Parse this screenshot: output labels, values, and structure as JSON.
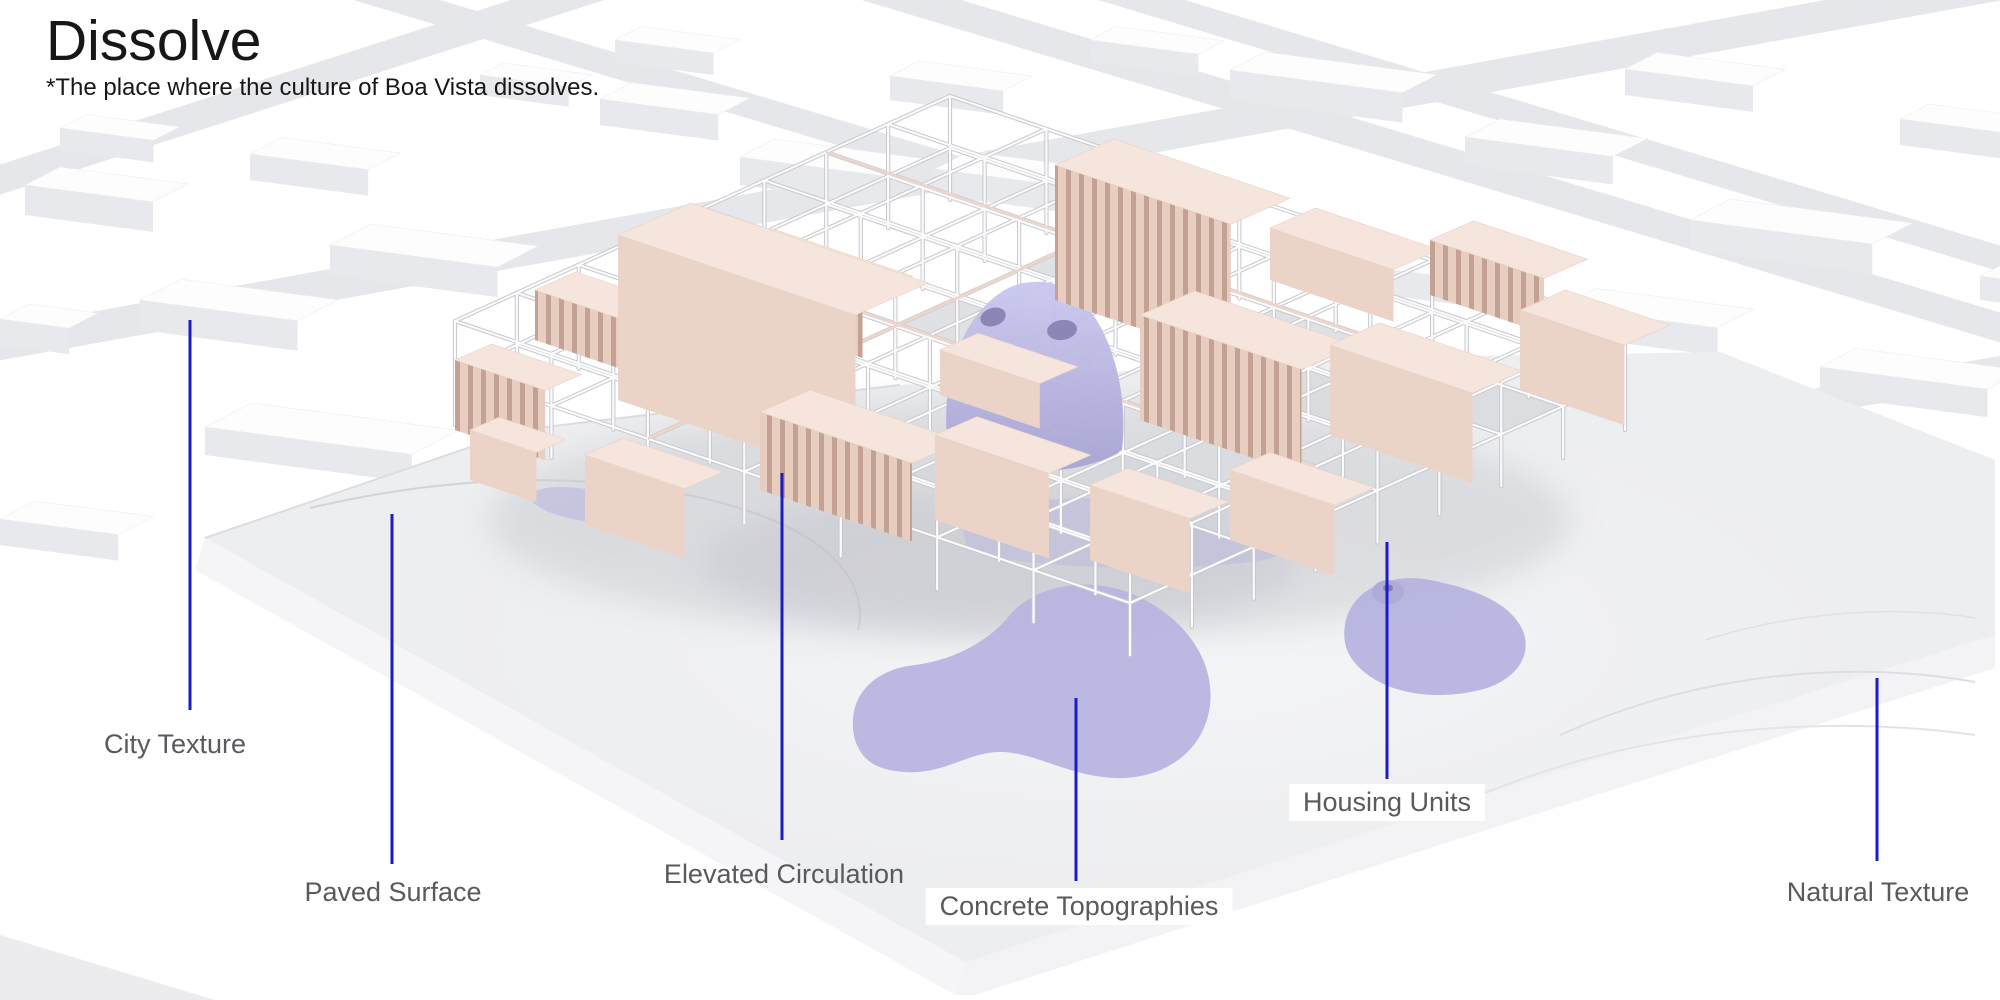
{
  "header": {
    "title": "Dissolve",
    "subtitle": "*The place where the culture of Boa Vista dissolves."
  },
  "legend": {
    "labels": [
      {
        "id": "city-texture",
        "text": "City Texture"
      },
      {
        "id": "paved-surface",
        "text": "Paved Surface"
      },
      {
        "id": "elevated-circulation",
        "text": "Elevated Circulation"
      },
      {
        "id": "concrete-topographies",
        "text": "Concrete Topographies"
      },
      {
        "id": "housing-units",
        "text": "Housing Units"
      },
      {
        "id": "natural-texture",
        "text": "Natural Texture"
      }
    ]
  },
  "colors": {
    "leader_line": "#1c1ac9",
    "label_text": "#595a5e",
    "title_text": "#171717",
    "housing_pink": "#eed7cc",
    "topography_purple": "#b6b3e0",
    "frame_white": "#fbfbfc",
    "ground_grey": "#edeef0",
    "street_grey": "#e6e7eb",
    "background_white": "#ffffff"
  }
}
